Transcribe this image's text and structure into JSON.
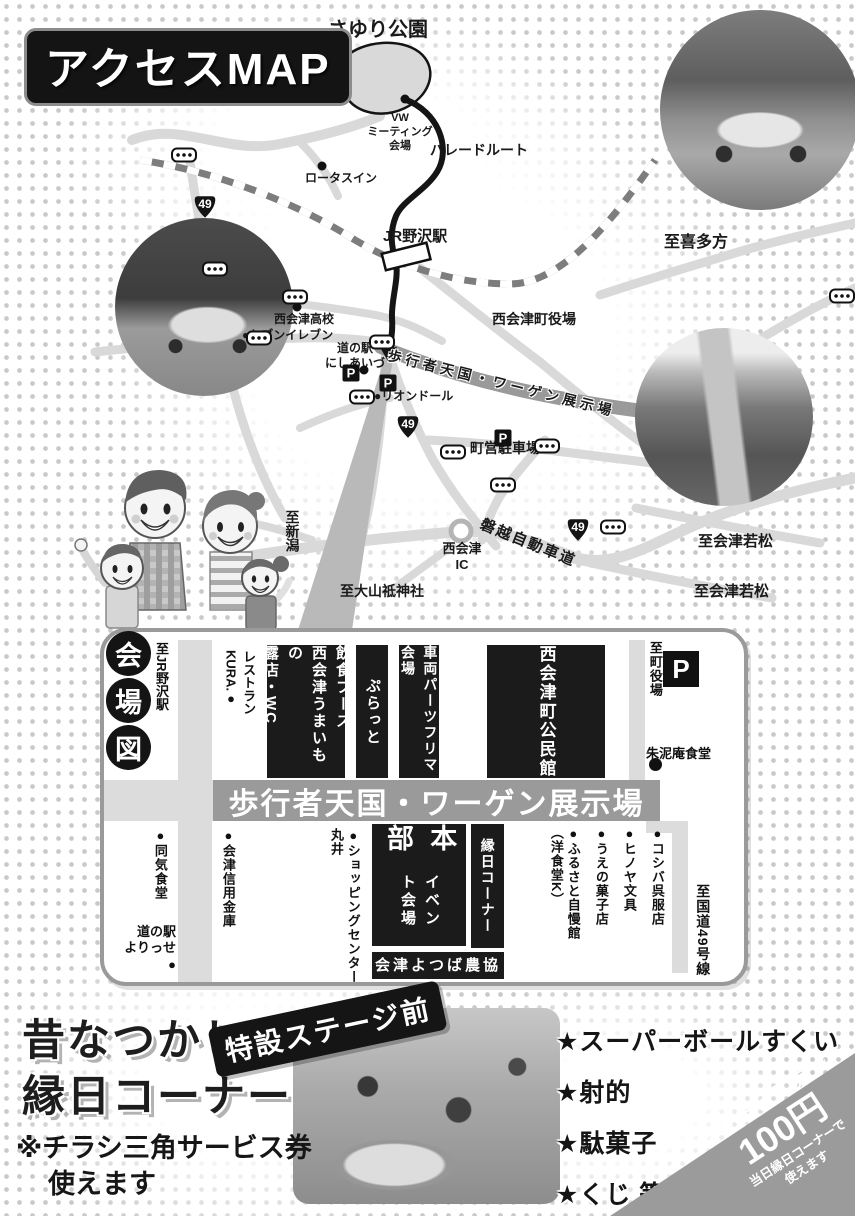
{
  "page": {
    "title": "アクセスMAP"
  },
  "map": {
    "route_number": "49",
    "parking_letter": "P",
    "road_color": "#d9d9d9",
    "route_color": "#151515",
    "dark_road_color": "#9a9a9a",
    "labels": [
      {
        "id": "sayuri-park",
        "text": "さゆり公園",
        "x": 328,
        "y": 18,
        "size": 20
      },
      {
        "id": "vw-meeting-site",
        "text": "VW\nミーティング\n会場",
        "x": 362,
        "y": 112,
        "size": 11,
        "w": 76
      },
      {
        "id": "parade-route",
        "text": "パレードルート",
        "x": 430,
        "y": 142,
        "size": 14
      },
      {
        "id": "lotus-inn",
        "text": "ロータスイン",
        "x": 305,
        "y": 171,
        "size": 12
      },
      {
        "id": "jr-nozawa-station",
        "text": "JR野沢駅",
        "x": 383,
        "y": 228,
        "size": 15
      },
      {
        "id": "to-kitakata",
        "text": "至喜多方",
        "x": 664,
        "y": 233,
        "size": 16
      },
      {
        "id": "nishiaizu-town-office",
        "text": "西会津町役場",
        "x": 492,
        "y": 311,
        "size": 14
      },
      {
        "id": "nishiaizu-high-school",
        "text": "西会津高校",
        "x": 274,
        "y": 312,
        "size": 12
      },
      {
        "id": "seven-eleven",
        "text": "●セブンイレブン",
        "x": 242,
        "y": 328,
        "size": 12
      },
      {
        "id": "michinoeki-nishiaizu",
        "text": "道の駅\nにしあいづ",
        "x": 323,
        "y": 341,
        "size": 12,
        "w": 64
      },
      {
        "id": "lion-dor",
        "text": "●リオンドール",
        "x": 374,
        "y": 389,
        "size": 12
      },
      {
        "id": "town-parking-lot",
        "text": "町営駐車場",
        "x": 470,
        "y": 440,
        "size": 14
      },
      {
        "id": "pedestrian-zone-road",
        "text": "歩行者天国・ワーゲン展示場",
        "x": 390,
        "y": 347,
        "size": 14,
        "rotate": 14,
        "halo": true,
        "spacing": 4
      },
      {
        "id": "banetsu-expressway",
        "text": "磐越自動車道",
        "x": 484,
        "y": 516,
        "size": 15,
        "rotate": 22,
        "spacing": 2
      },
      {
        "id": "nishiaizu-ic",
        "text": "西会津\nIC",
        "x": 436,
        "y": 541,
        "size": 13,
        "w": 52
      },
      {
        "id": "to-niigata",
        "text": "至新潟",
        "x": 283,
        "y": 510,
        "size": 14,
        "vertical": true
      },
      {
        "id": "to-oyamazumi-shrine",
        "text": "至大山祗神社",
        "x": 340,
        "y": 583,
        "size": 14
      },
      {
        "id": "to-aizu-wakamatsu-north",
        "text": "至会津若松",
        "x": 698,
        "y": 533,
        "size": 15
      },
      {
        "id": "to-aizu-wakamatsu-south",
        "text": "至会津若松",
        "x": 694,
        "y": 583,
        "size": 15
      }
    ],
    "signals": [
      [
        184,
        155
      ],
      [
        215,
        269
      ],
      [
        295,
        297
      ],
      [
        259,
        338
      ],
      [
        382,
        342
      ],
      [
        362,
        397
      ],
      [
        453,
        452
      ],
      [
        547,
        446
      ],
      [
        503,
        485
      ],
      [
        613,
        527
      ],
      [
        842,
        296
      ]
    ],
    "shields": [
      [
        205,
        207
      ],
      [
        408,
        427
      ],
      [
        578,
        530
      ]
    ],
    "parkings": [
      [
        351,
        373
      ],
      [
        388,
        383
      ],
      [
        503,
        438
      ]
    ],
    "dots": [
      [
        405,
        99
      ],
      [
        322,
        166
      ],
      [
        297,
        307
      ],
      [
        364,
        370
      ]
    ]
  },
  "venue": {
    "title_chars": [
      "会",
      "場",
      "図"
    ],
    "to_jr_label": "至JR野沢駅",
    "restaurant_kura": "レストラン\nKURA.●",
    "street_band": "歩行者天国・ワーゲン展示場",
    "parking_letter": "P",
    "shunjian_label": "朱泥庵食堂",
    "yorisse_label": "道の駅\nよりっせ\n●",
    "boxes": [
      {
        "id": "food-booth",
        "text": "飲食ブース\n西会津うまいもの\n露店・WC",
        "x": 267,
        "y": 645,
        "w": 78,
        "h": 133,
        "size": 15
      },
      {
        "id": "puratto",
        "text": "ぷらっと",
        "x": 356,
        "y": 645,
        "w": 32,
        "h": 133,
        "size": 15
      },
      {
        "id": "car-parts-flea-market",
        "text": "車両パーツフリマ会場",
        "x": 399,
        "y": 645,
        "w": 40,
        "h": 133,
        "size": 14
      },
      {
        "id": "community-center",
        "text": "西会津町公民館",
        "x": 487,
        "y": 645,
        "w": 118,
        "h": 133,
        "size": 17
      },
      {
        "id": "headquarters",
        "main": "本部",
        "sub": "イベント会場",
        "x": 372,
        "y": 824,
        "w": 94,
        "h": 122
      },
      {
        "id": "ennichi-corner",
        "text": "縁日コーナー",
        "x": 471,
        "y": 824,
        "w": 33,
        "h": 124,
        "size": 14
      },
      {
        "id": "ja-aizu-yotsuba",
        "text": "会津よつば農協",
        "x": 372,
        "y": 952,
        "w": 132,
        "h": 27,
        "size": 15,
        "horizontal": true
      }
    ],
    "dot_labels": [
      {
        "id": "douki-shokudou",
        "text": "●同気食堂",
        "x": 151,
        "y": 828
      },
      {
        "id": "aizu-shinkin-bank",
        "text": "●会津信用金庫",
        "x": 219,
        "y": 828
      },
      {
        "id": "shopping-center-marui",
        "text": "●ショッピングセンター\n丸井",
        "x": 327,
        "y": 828
      },
      {
        "id": "koshiba-gofukuten",
        "text": "●コシバ呉服店",
        "x": 648,
        "y": 826
      },
      {
        "id": "hinoya-bungu",
        "text": "●ヒノヤ文具",
        "x": 620,
        "y": 826
      },
      {
        "id": "ueno-kashiten",
        "text": "●うえの菓子店",
        "x": 592,
        "y": 826
      },
      {
        "id": "furusato-jimankan",
        "text": "●ふるさと自慢館\n（洋食堂K）",
        "x": 547,
        "y": 826
      },
      {
        "id": "to-route-49",
        "text": "至国道49号線",
        "x": 694,
        "y": 884,
        "size": 14
      },
      {
        "id": "to-town-office",
        "text": "至町役場",
        "x": 646,
        "y": 641
      }
    ]
  },
  "ennichi": {
    "title_line1": "昔なつかし",
    "title_line2": "縁日コーナー",
    "stage_badge": "特設ステージ前",
    "note_line1": "※チラシ三角サービス券",
    "note_line2": "使えます",
    "items": [
      "★スーパーボールすくい",
      "★射的",
      "★駄菓子",
      "★くじ 等"
    ]
  },
  "service": {
    "deco": "≋",
    "line1": "サービス券",
    "line2": "100円",
    "line3": "当日縁日コーナーで\n使えます"
  }
}
